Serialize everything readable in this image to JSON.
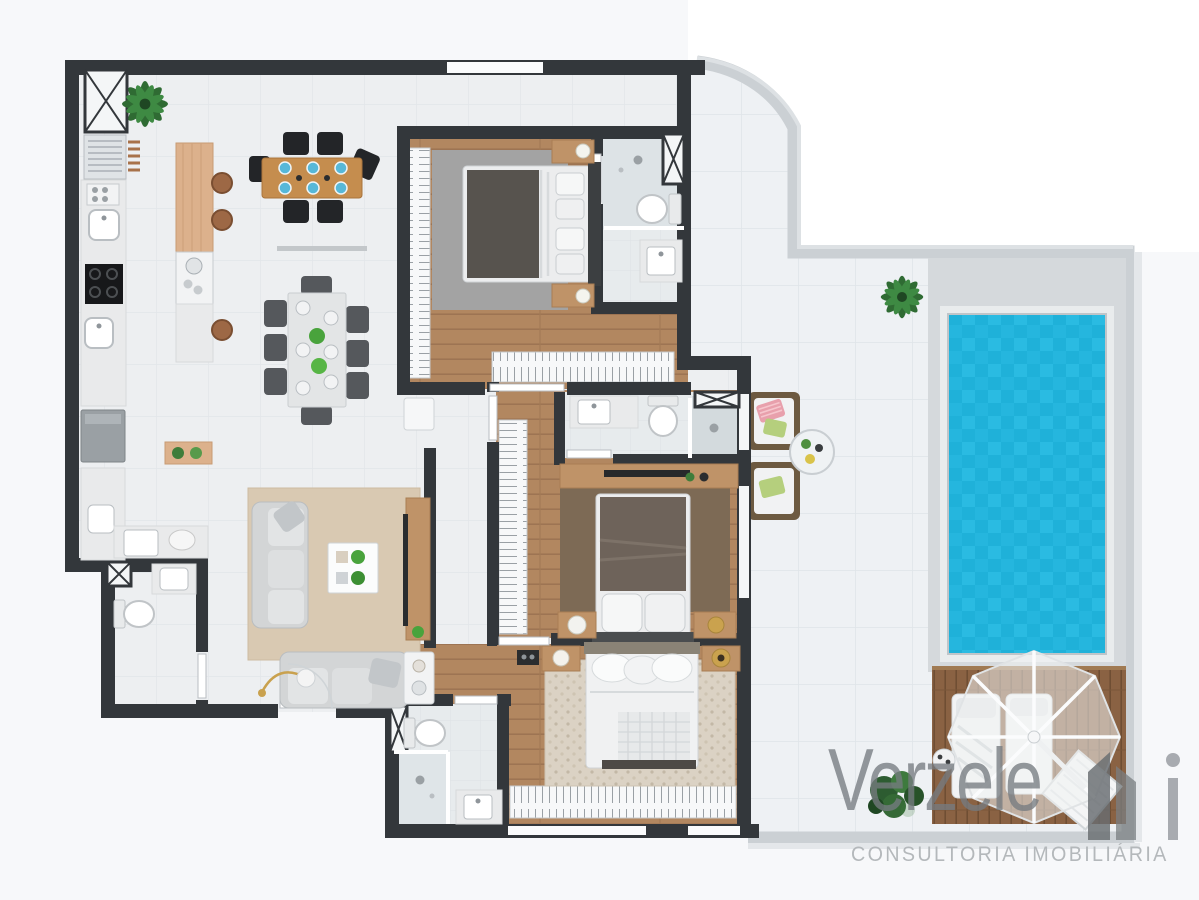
{
  "brand": {
    "name": "Verzele",
    "tagline": "CONSULTORIA IMOBILIÁRIA"
  },
  "palette": {
    "wall": "#33373b",
    "tile_indoor": "#edeff1",
    "tile_outdoor": "#eef1f4",
    "tile_line": "#e0e4e8",
    "wood_floor": "#b28760",
    "wood_line": "#9a7251",
    "deck_wood": "#8a6243",
    "deck_line": "#6f4e33",
    "pool_water": "#1fb1d9",
    "pool_water_alt": "#2abbe2",
    "pool_deck": "#d5d9dc",
    "parapet": "#cbd0d4",
    "rug_gray": "#a3a3a3",
    "rug_beige": "#d9c9b2",
    "rug_brown": "#7d6a55",
    "rug_dots": "#dbd2c4",
    "furniture_wood": "#bf9368",
    "chair_dark": "#232528",
    "plant_green": "#3e7a3e",
    "logo_gray": "#767b80",
    "tagline_gray": "#b4b8bb",
    "umbrella": "#f0f2f3"
  },
  "floorplan": {
    "view": "3d-top-down-render",
    "unit": "apartment-with-terrace-pool",
    "rooms": [
      {
        "id": "kitchen",
        "features": [
          "service-shaft",
          "grill",
          "counter",
          "cooktop",
          "double-sinks",
          "island",
          "bar-stools"
        ]
      },
      {
        "id": "dining-area",
        "features": [
          "wood-table-6-seats",
          "white-table-8-seats",
          "wall-shelf"
        ]
      },
      {
        "id": "living-room",
        "features": [
          "sofa",
          "sofa-2",
          "coffee-table",
          "tv-console",
          "arc-floor-lamp",
          "side-table"
        ]
      },
      {
        "id": "laundry",
        "features": [
          "washer",
          "tank-sink",
          "shelf"
        ]
      },
      {
        "id": "powder-room",
        "features": [
          "toilet",
          "sink"
        ]
      },
      {
        "id": "foyer",
        "features": [
          "entry-door"
        ]
      },
      {
        "id": "suite-1",
        "features": [
          "double-bed",
          "nightstands",
          "closet",
          "wardrobe",
          "rug"
        ]
      },
      {
        "id": "bathroom-1",
        "features": [
          "shower",
          "toilet",
          "vanity",
          "shaft"
        ]
      },
      {
        "id": "suite-2",
        "features": [
          "double-bed",
          "nightstands",
          "closet",
          "tv-console",
          "rug"
        ]
      },
      {
        "id": "bathroom-2",
        "features": [
          "shower",
          "toilet",
          "vanity",
          "vent"
        ]
      },
      {
        "id": "suite-3",
        "features": [
          "double-bed",
          "side-tables",
          "wardrobe",
          "rug"
        ]
      },
      {
        "id": "bathroom-3",
        "features": [
          "shower",
          "toilet",
          "vanity",
          "shaft"
        ]
      },
      {
        "id": "hallway",
        "features": []
      },
      {
        "id": "terrace",
        "features": [
          "wicker-armchair",
          "wicker-armchair-2",
          "round-table",
          "palm-plants"
        ]
      },
      {
        "id": "pool",
        "features": [
          "tiled-water",
          "stone-surround"
        ]
      },
      {
        "id": "sun-deck",
        "features": [
          "umbrella",
          "lounger",
          "lounger-2",
          "side-table",
          "towel",
          "shrub"
        ]
      }
    ]
  }
}
